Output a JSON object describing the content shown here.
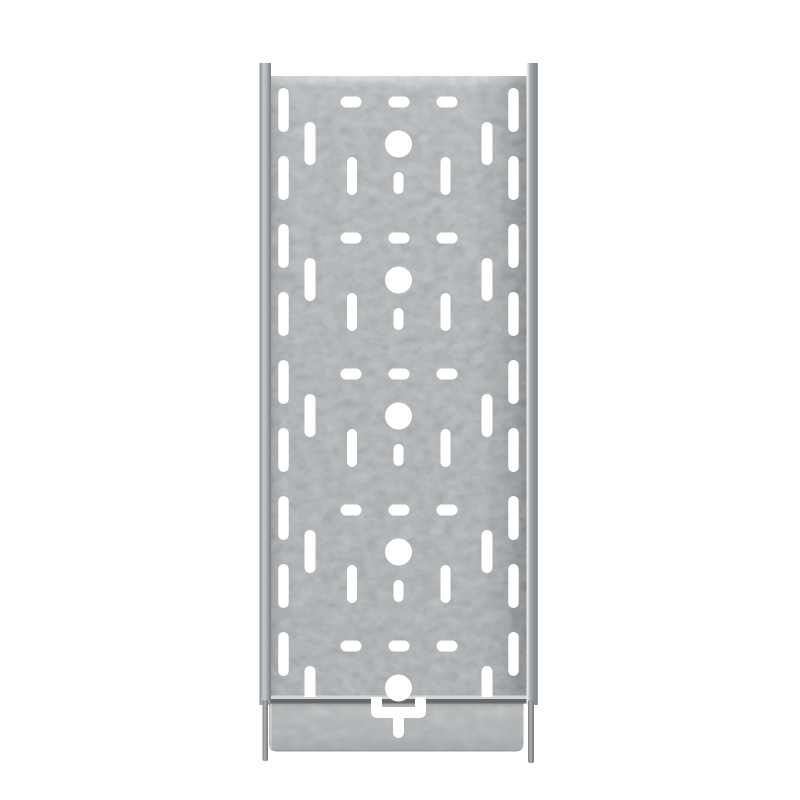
{
  "meta": {
    "description": "Product photograph of a galvanized steel perforated cable tray, straight front view, centered on a plain white background",
    "background_color": "#ffffff"
  },
  "colors": {
    "metal_base": "#b6b9bb",
    "metal_highlight": "#d8dadb",
    "metal_shadow": "#8d9092",
    "seam_dark": "#66696b",
    "hole_color": "#ffffff"
  },
  "perforations": {
    "unit_count": 5,
    "first_row_y": 102,
    "row_spacing": 136,
    "dash_row": {
      "x_centers": [
        351,
        399,
        447
      ],
      "width": 21,
      "height": 11
    },
    "center_circles": {
      "x_center": 398.5,
      "offset_y": 42,
      "radius": 13.5
    },
    "inner_slots": {
      "x_centers": [
        310,
        487
      ],
      "offset_y": 20,
      "width": 11,
      "height": 43
    },
    "outer_slots": {
      "x_centers": [
        352,
        445.5
      ],
      "offset_y": 55,
      "width": 10,
      "height": 38,
      "omit_in_last_unit": true
    },
    "small_slots": {
      "x_center": 398.5,
      "offset_y": 70,
      "width": 10,
      "height": 22,
      "omit_in_last_unit": true
    },
    "edge_slots": {
      "x_centers": [
        283.5,
        513.5
      ],
      "first_y": 88,
      "spacing": 68,
      "count": 9,
      "width": 10.5,
      "height": 44
    },
    "clip_bottom_y": 697
  },
  "bracket": {
    "x_center": 398.5,
    "top_y": 697,
    "outer_width": 55,
    "outer_height": 21,
    "arm_width": 11,
    "corner_radius": 7,
    "stem_width": 11,
    "stem_top_y": 712,
    "stem_height": 26,
    "stem_radius": 5.5
  }
}
